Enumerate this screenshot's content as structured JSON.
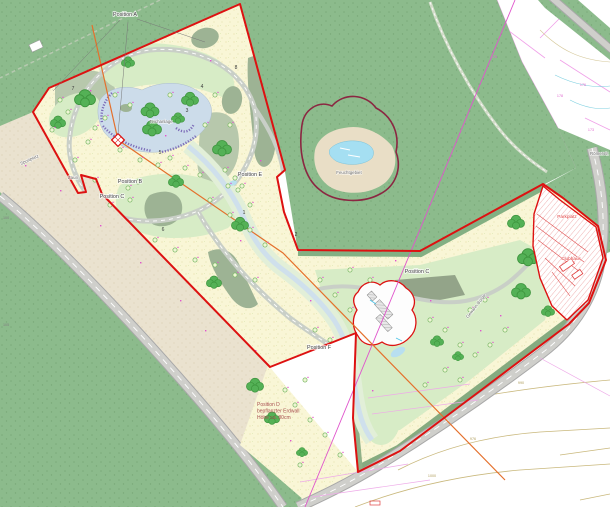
{
  "colors": {
    "red": "#dd1111",
    "red2": "#e04040",
    "maroon": "#8b2742",
    "magenta": "#e055cc",
    "orange": "#e4702c",
    "water": "#a5dff2",
    "lake": "#ccdcea",
    "purple": "#7d6cb8",
    "forest": "#8cbb8c",
    "cream": "#f9f6d6",
    "tan": "#eae2cf",
    "fairway": "#d7ecc6"
  },
  "map": {
    "position_labels": [
      {
        "t": "Position A",
        "x": 125,
        "y": 16
      },
      {
        "t": "Position B",
        "x": 130,
        "y": 183
      },
      {
        "t": "Position C",
        "x": 112,
        "y": 198
      },
      {
        "t": "Position E",
        "x": 250,
        "y": 176
      },
      {
        "t": "Position C",
        "x": 417,
        "y": 273
      },
      {
        "t": "Position F",
        "x": 319,
        "y": 349
      }
    ],
    "area_labels": [
      {
        "t": "Sportplatz",
        "x": 30,
        "y": 161,
        "r": -24
      },
      {
        "t": "Zaun",
        "x": 68,
        "y": 179,
        "a": "start"
      },
      {
        "t": "Teichanlage",
        "x": 161,
        "y": 123
      },
      {
        "t": "Feuchtgebiet",
        "x": 349,
        "y": 174
      },
      {
        "t": "Gewann Bürge",
        "x": 477,
        "y": 307,
        "r": -52
      },
      {
        "t": "Römerstr.",
        "x": 609,
        "y": 155,
        "a": "end"
      }
    ],
    "red_labels": [
      {
        "t": "Parkplatz",
        "x": 567,
        "y": 218
      },
      {
        "t": "Clubhaus",
        "x": 571,
        "y": 260
      }
    ],
    "note_d": {
      "x": 257,
      "y": 406,
      "lines": [
        "Position D",
        "bepflanzter Erdwall",
        "Höhe ca. 80cm"
      ]
    },
    "hole_numbers": [
      {
        "t": "7",
        "x": 73,
        "y": 90
      },
      {
        "t": "8",
        "x": 236,
        "y": 69
      },
      {
        "t": "4",
        "x": 202,
        "y": 88
      },
      {
        "t": "3",
        "x": 187,
        "y": 112
      },
      {
        "t": "5",
        "x": 160,
        "y": 154
      },
      {
        "t": "1",
        "x": 244,
        "y": 214
      },
      {
        "t": "6",
        "x": 163,
        "y": 231
      },
      {
        "t": "2",
        "x": 296,
        "y": 236
      }
    ],
    "contour_labels": [
      {
        "t": "990",
        "x": 521,
        "y": 384
      },
      {
        "t": "976",
        "x": 473,
        "y": 440
      },
      {
        "t": "1000",
        "x": 432,
        "y": 477
      }
    ],
    "parcel_numbers": [
      {
        "t": "176",
        "x": 583,
        "y": 86
      },
      {
        "t": "175",
        "x": 494,
        "y": 58
      },
      {
        "t": "178",
        "x": 560,
        "y": 97
      },
      {
        "t": "173",
        "x": 591,
        "y": 131
      }
    ],
    "elevation_labels": [
      {
        "t": "100",
        "x": 3,
        "y": 219,
        "a": "start"
      },
      {
        "t": "105",
        "x": 3,
        "y": 326,
        "a": "start"
      }
    ]
  }
}
